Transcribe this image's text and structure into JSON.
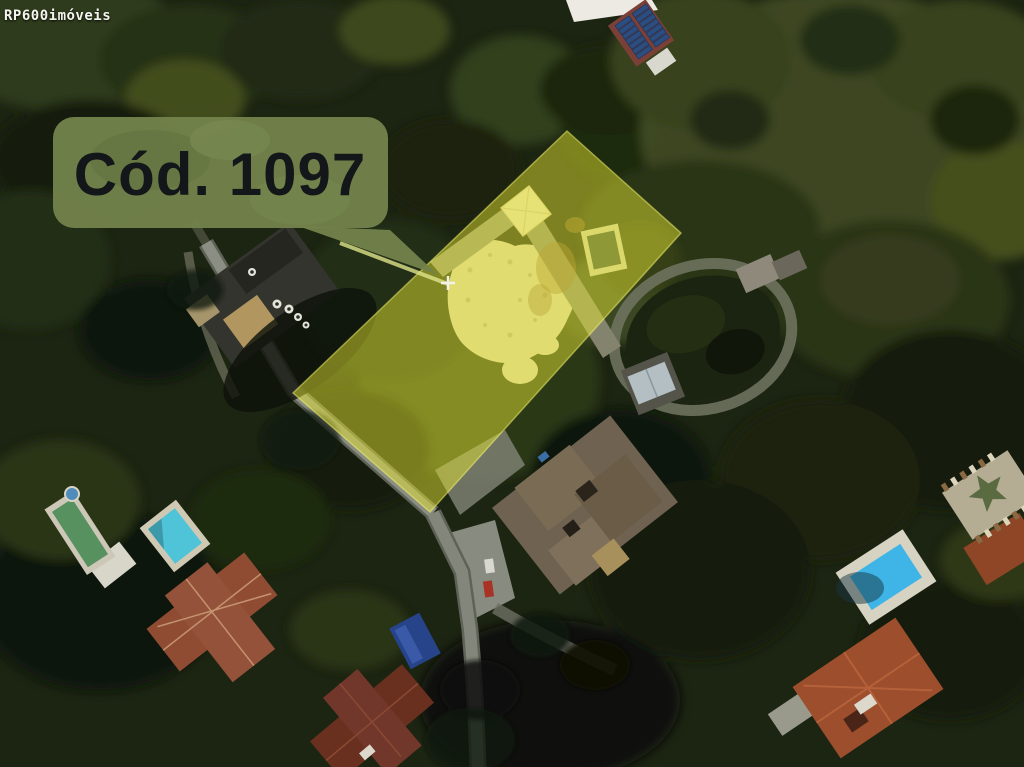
{
  "watermark": {
    "text": "RP600imóveis"
  },
  "annotation": {
    "code_label": "Cód. 1097",
    "marker": "plus"
  },
  "colors": {
    "highlight_yellow": "#e8e832",
    "highlight_edge": "#f8f870",
    "label_green": "#72824b",
    "label_text": "#14171a",
    "watermark_text": "#f4f4ee",
    "leader_line": "#dfe48a"
  }
}
